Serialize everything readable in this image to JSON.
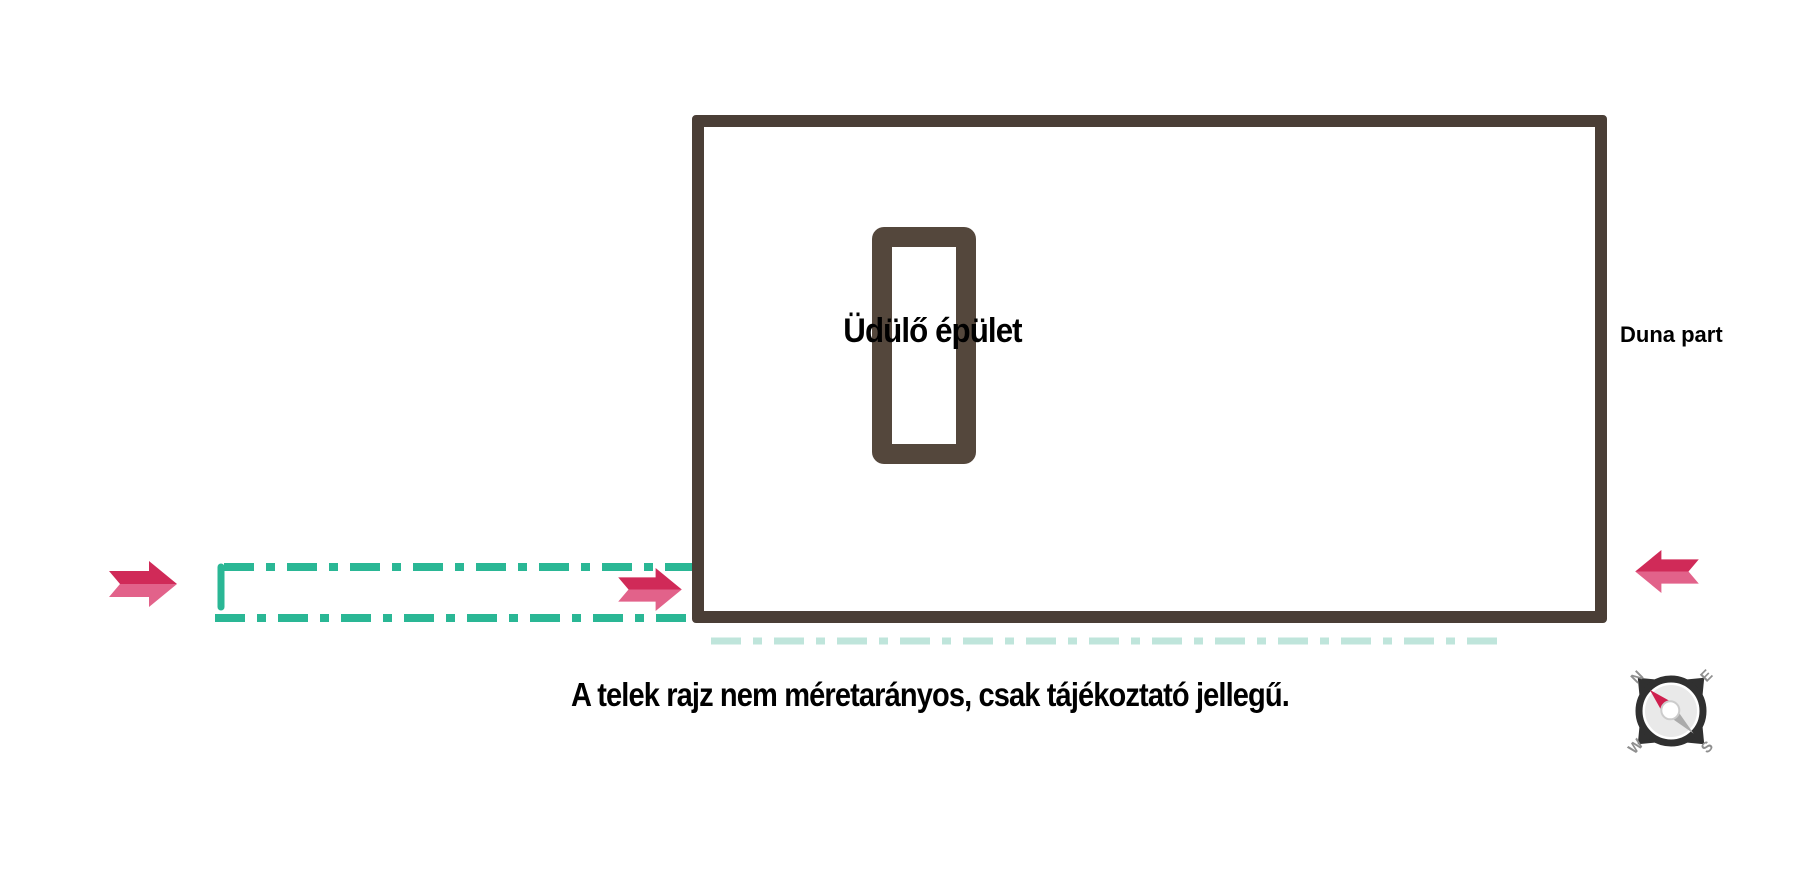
{
  "plan": {
    "building_label": "Üdülő épület",
    "shore_label": "Duna part",
    "caption": "A telek rajz nem méretarányos, csak tájékoztató jellegű."
  },
  "compass": {
    "north": "N",
    "east": "E",
    "south": "S",
    "west": "W"
  },
  "icons": {
    "direction_arrow": "➜ thick notched arrow",
    "compass": "compass rose rotated -45°, red needle toward N (upper-left)"
  },
  "colors": {
    "background": "#ffffff",
    "plot_outline": "#4a3e36",
    "building_outline": "#54473c",
    "access_dash": "#2ab795",
    "shoreline_dash": "#bfe5db",
    "arrow_dark": "#d02a58",
    "arrow_light": "#e2628a",
    "label_text": "#000000",
    "compass_ring": "#303030",
    "compass_face": "#e9e9e9",
    "compass_letter": "#8f8f8f",
    "needle_red": "#cf1f4e",
    "needle_gray": "#ababab"
  }
}
